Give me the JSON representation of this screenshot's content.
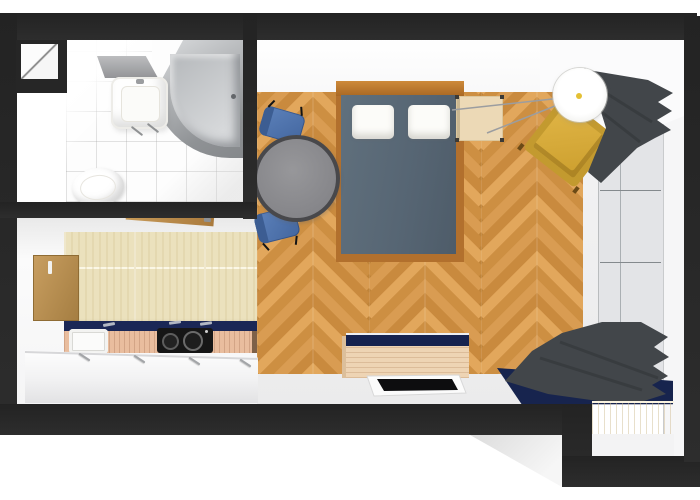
{
  "meta": {
    "title": "Studio apartment floor plan — 3D top-down render",
    "view": "top-down perspective"
  },
  "palette": {
    "wall": "#282828",
    "parquet_wood": "#d59a55",
    "kitchen_tile": "#ebe1bd",
    "bathroom_tile": "#fdfdfd",
    "navy_accent": "#17244e",
    "duvet_blue_gray": "#5a6a78",
    "bed_frame_wood": "#b2702d",
    "chair_blue": "#4f74ae",
    "armchair_yellow": "#cf9f33",
    "curtain_gray": "#42464a",
    "table_gray": "#8d8d8f",
    "counter_wood": "#e9bd9e",
    "bench_wood": "#f4e7cb",
    "window_glass": "#e3e4e7"
  },
  "rooms": {
    "bathroom": {
      "label": "Bathroom",
      "floor": "white tile"
    },
    "kitchen": {
      "label": "Kitchen",
      "floor": "beige tile"
    },
    "living": {
      "label": "Living / bedroom",
      "floor": "herringbone parquet"
    }
  },
  "furniture": {
    "closet": {
      "label": "Closet niche"
    },
    "bathtub": {
      "label": "Bathtub"
    },
    "washbasin": {
      "label": "Washbasin with mirror"
    },
    "mirror": {
      "label": "Mirror"
    },
    "toilet": {
      "label": "Toilet"
    },
    "entry_door": {
      "label": "Open interior door"
    },
    "side_door": {
      "label": "Door on left wall"
    },
    "kitchen_counter": {
      "label": "Kitchen counter"
    },
    "kitchen_sink": {
      "label": "Kitchen sink"
    },
    "cooktop": {
      "label": "Cooktop with two burners"
    },
    "bed": {
      "label": "Double bed with slate-blue duvet"
    },
    "pillow_left": {
      "label": "Pillow"
    },
    "pillow_right": {
      "label": "Pillow"
    },
    "nightstand": {
      "label": "Nightstand"
    },
    "dining_table": {
      "label": "Round dining table"
    },
    "chair_upper": {
      "label": "Blue chair"
    },
    "chair_lower": {
      "label": "Blue chair"
    },
    "floor_lamp": {
      "label": "Tripod floor lamp"
    },
    "armchair": {
      "label": "Mustard armchair"
    },
    "curtain_upper": {
      "label": "Dark gray curtain (upper window)"
    },
    "curtain_lower": {
      "label": "Dark gray curtain (lower window)"
    },
    "window": {
      "label": "Window front"
    },
    "sideboard": {
      "label": "Sideboard with navy top"
    },
    "tv": {
      "label": "Flat-screen TV"
    },
    "bench": {
      "label": "Window bench"
    },
    "mat": {
      "label": "Navy corner mat"
    }
  }
}
